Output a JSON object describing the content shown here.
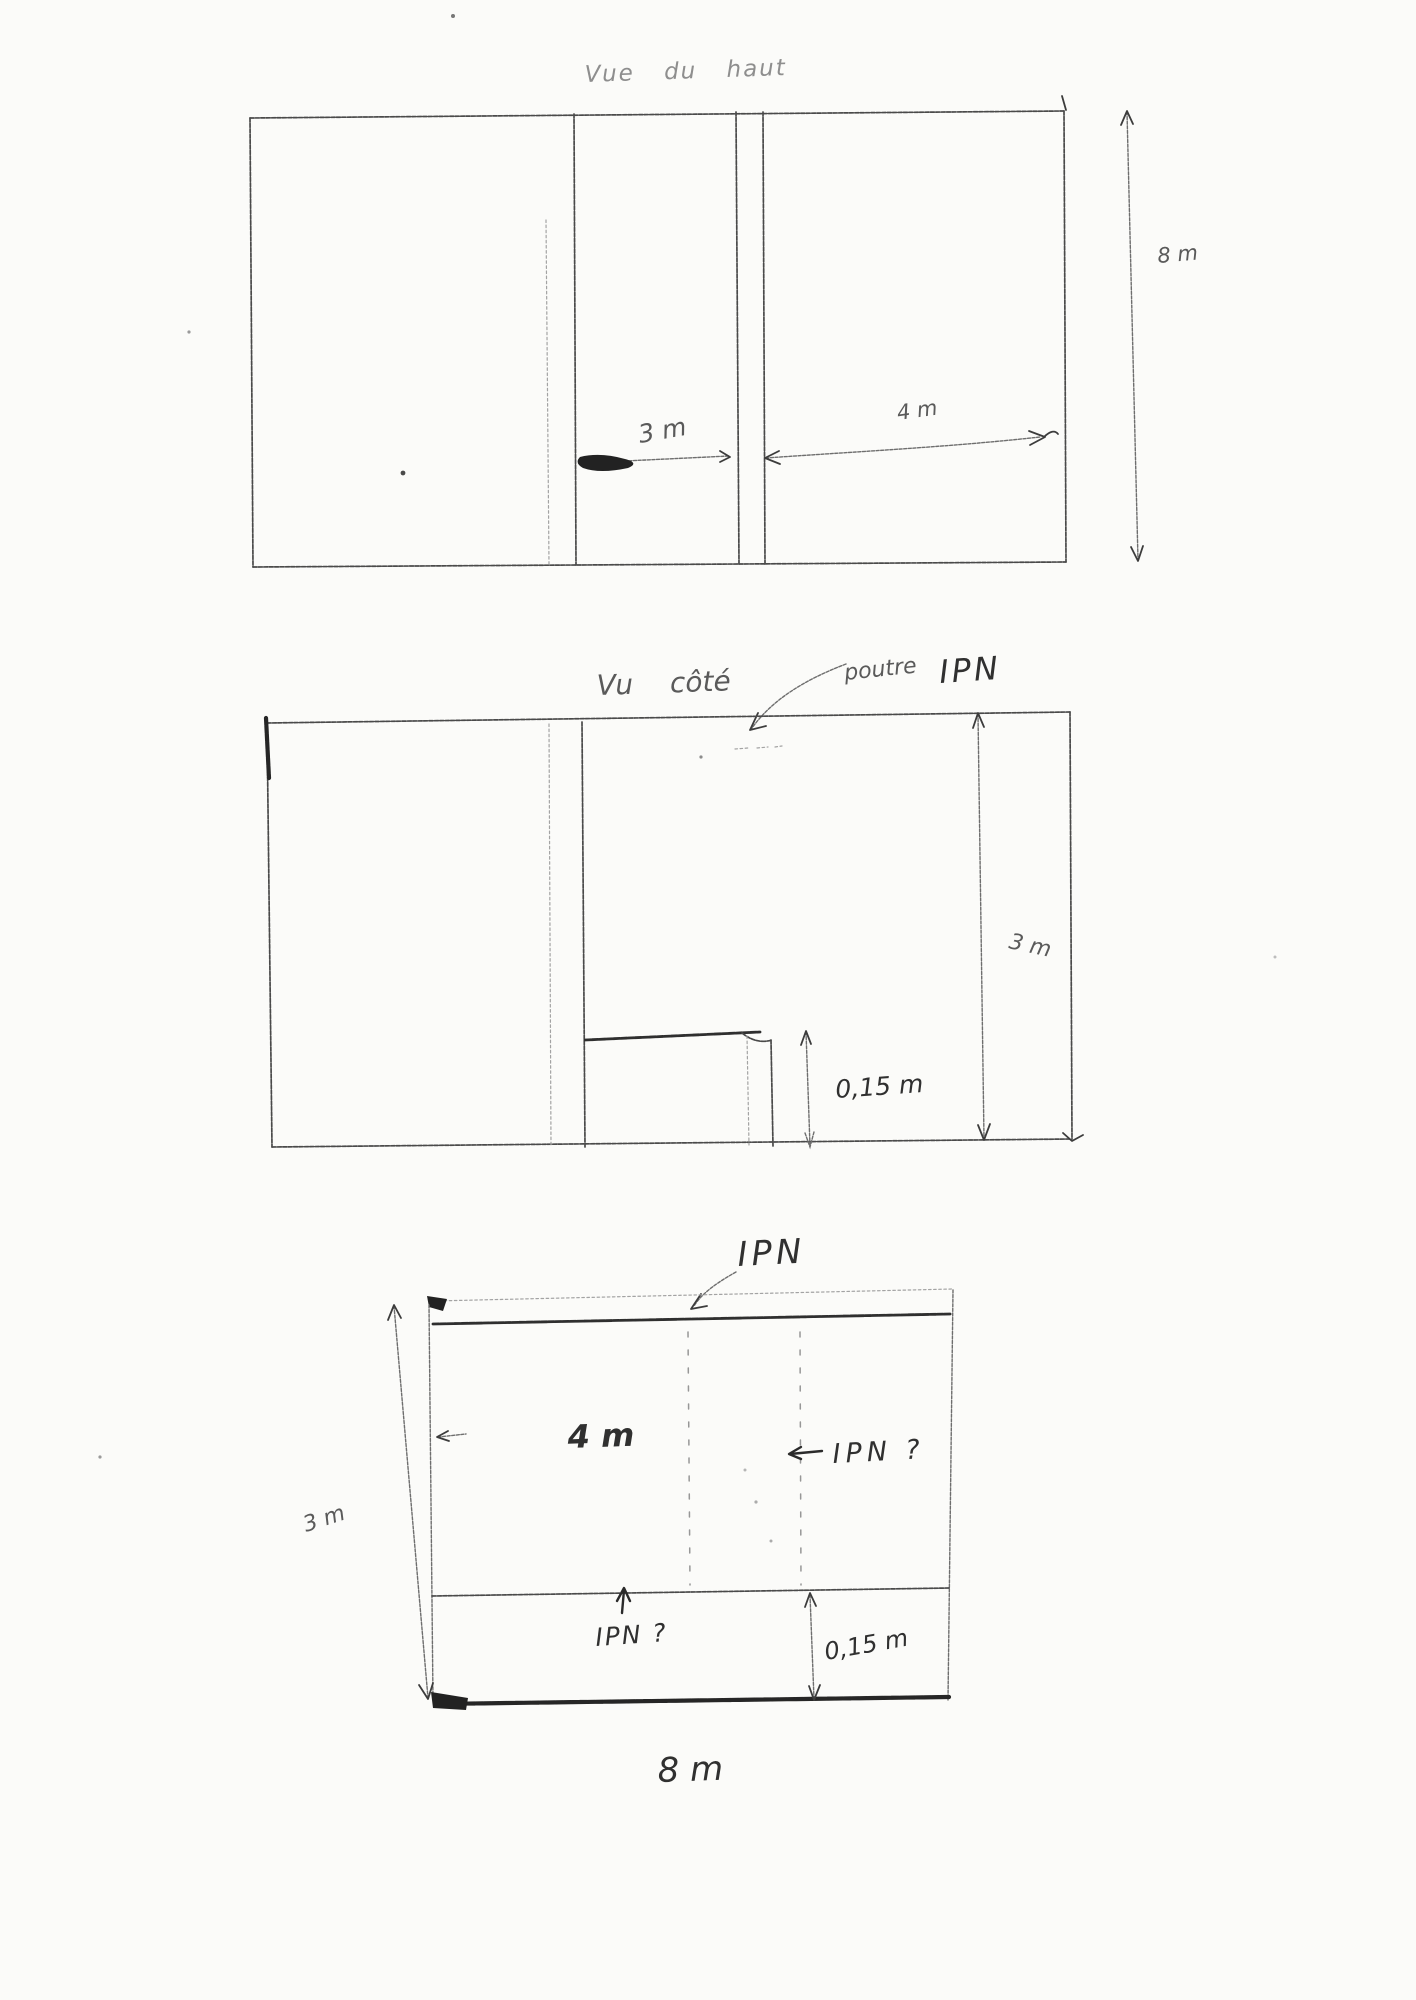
{
  "page": {
    "paper_color": "#fbfbf9",
    "pencil_color": "#4a4a4a"
  },
  "top_view": {
    "title": "Vue du haut",
    "dim_inner_left": "3 m",
    "dim_inner_right": "4 m",
    "dim_height_right": "8 m"
  },
  "side_view": {
    "title": "Vu côté",
    "beam_word": "poutre",
    "beam_acronym": "IPN",
    "dim_height": "3 m",
    "dim_step": "0,15 m"
  },
  "front_view": {
    "title": "IPN",
    "dim_inner_width": "4 m",
    "beam_query": "IPN ?",
    "dim_height_left": "3 m",
    "bottom_beam_query": "IPN ?",
    "dim_step": "0,15 m",
    "dim_total_width": "8 m"
  }
}
